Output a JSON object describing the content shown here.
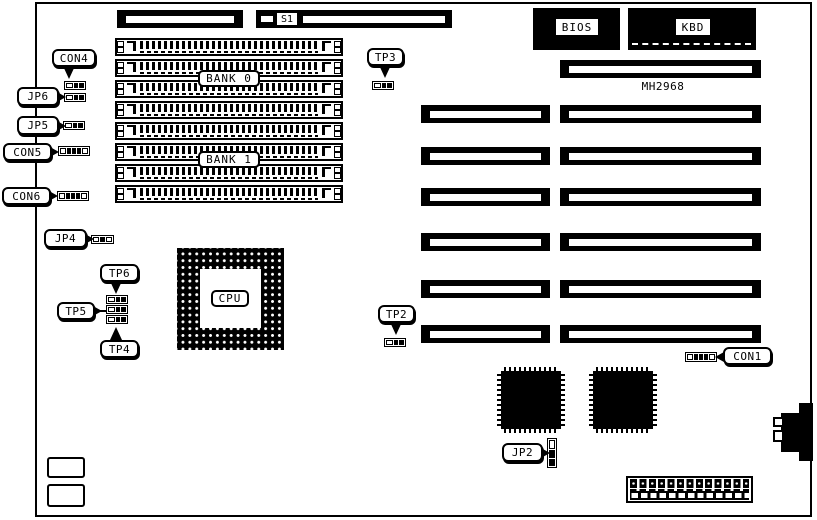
{
  "board": {
    "labels": {
      "s1": "S1",
      "bios": "BIOS",
      "kbd": "KBD",
      "mh2968": "MH2968",
      "bank0": "BANK 0",
      "bank1": "BANK 1",
      "cpu": "CPU",
      "con4": "CON4",
      "jp6": "JP6",
      "jp5": "JP5",
      "con5": "CON5",
      "con6": "CON6",
      "jp4": "JP4",
      "tp6": "TP6",
      "tp5": "TP5",
      "tp4": "TP4",
      "tp3": "TP3",
      "tp2": "TP2",
      "con1": "CON1",
      "jp2": "JP2"
    },
    "colors": {
      "ink": "#000000",
      "background": "#ffffff"
    }
  }
}
